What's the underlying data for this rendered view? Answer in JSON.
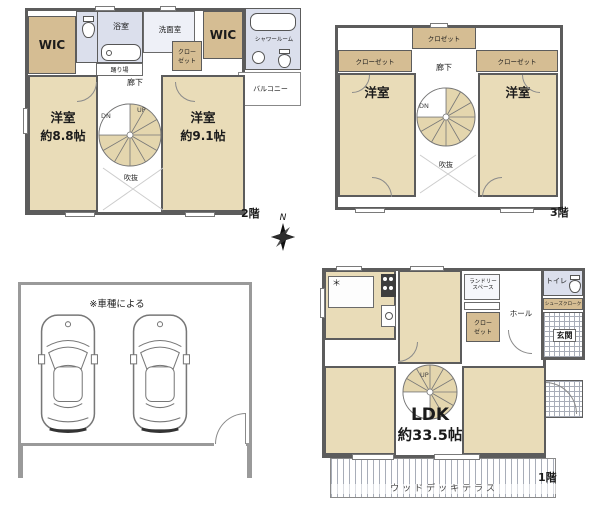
{
  "colors": {
    "wall": "#5c5c5c",
    "room": "#e9dcb8",
    "closet": "#d5bd93",
    "wet": "#dbdfec",
    "tile": "#a8adb8",
    "stair": "#e4d6ae",
    "line": "#8a8a8a"
  },
  "floor2": {
    "floor_label": "2階",
    "wic_left": "WIC",
    "bath": "浴室",
    "washroom": "洗面室",
    "landing": "踊り場",
    "closet_line1": "クロー",
    "closet_line2": "ゼット",
    "wic_right": "WIC",
    "shower_room": "シャワールーム",
    "balcony": "バルコニー",
    "hallway": "廊下",
    "room_left_name": "洋室",
    "room_left_area": "約8.8帖",
    "room_right_name": "洋室",
    "room_right_area": "約9.1帖",
    "void": "吹抜",
    "stair_up": "UP",
    "stair_down": "DN"
  },
  "floor3": {
    "floor_label": "3階",
    "closet_top": "クロゼット",
    "closet_left": "クローゼット",
    "closet_right": "クローゼット",
    "hallway": "廊下",
    "room_left": "洋室",
    "room_right": "洋室",
    "void": "吹抜",
    "stair_down": "DN"
  },
  "garage": {
    "note": "※車種による"
  },
  "floor1": {
    "floor_label": "1階",
    "laundry_line1": "ランドリー",
    "laundry_line2": "スペース",
    "closet_line1": "クロー",
    "closet_line2": "ゼット",
    "hall": "ホール",
    "toilet": "トイレ",
    "shoe_closet": "シューズクローク",
    "entrance": "玄関",
    "pantry_mark": "＊",
    "ldk_name": "LDK",
    "ldk_area": "約33.5帖",
    "stair_up": "UP",
    "deck": "ウッドデッキテラス"
  },
  "compass": {
    "north": "N"
  }
}
